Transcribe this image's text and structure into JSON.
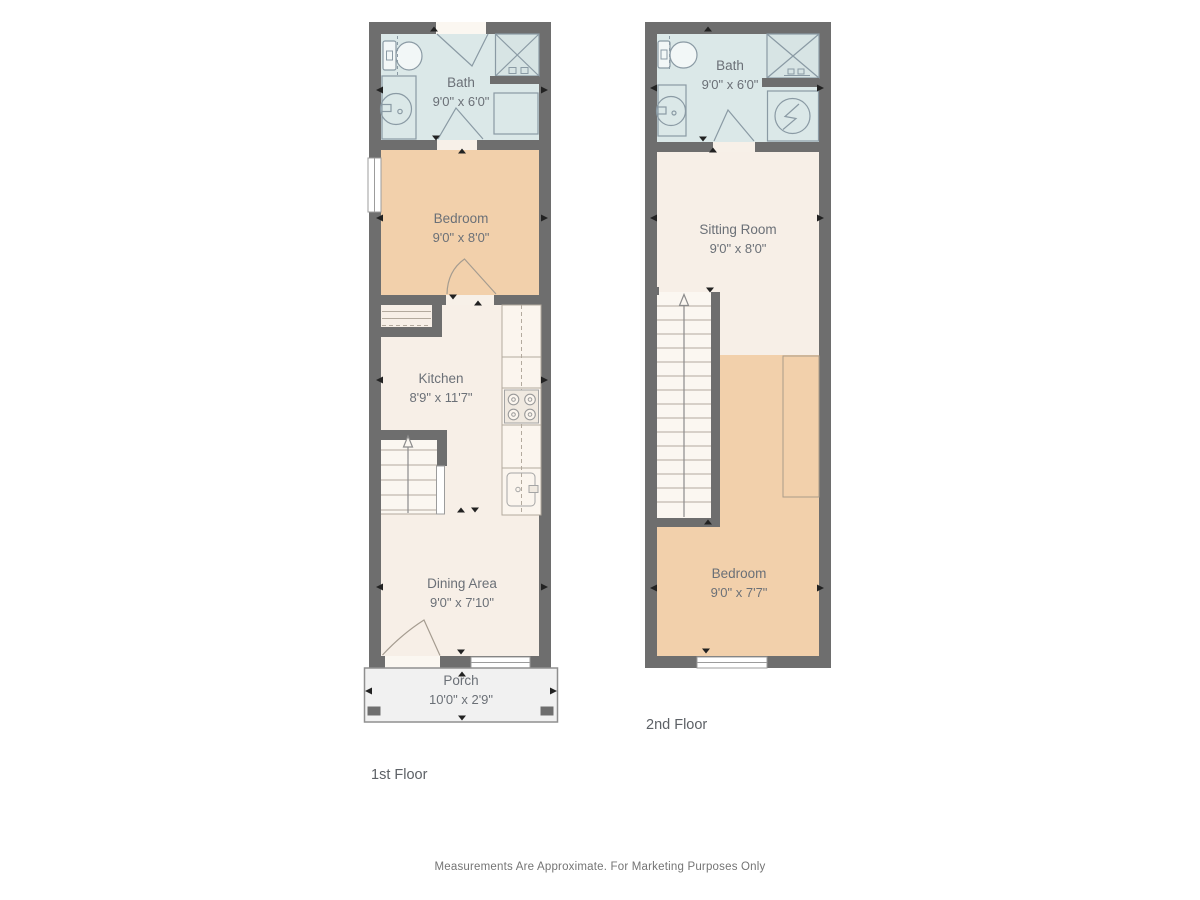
{
  "title": "Two-story townhouse floor plan",
  "colors": {
    "wall": "#6e6e6e",
    "bath": "#dbe8e8",
    "bedroom": "#f2d0ab",
    "cream": "#f7efe7",
    "porch": "#f1f1f1",
    "porch_border": "#8f8f8f",
    "stairs": "#fbf7f1",
    "opening": "#f7f0e8",
    "exterior_opening": "#fbf7f1",
    "window": "#ffffff",
    "window_border": "#9c9c9c",
    "fixture": "#8a9aa4",
    "wood": "#a59c90",
    "line": "#b3aa9e",
    "counter": "#fbf5ee",
    "stove": "#f0e9e0",
    "closet": "#ab9c8a",
    "arrow": "#222222",
    "label": "#6b7077",
    "floor_label": "#5d6166",
    "disclaimer": "#747474"
  },
  "floors": [
    {
      "label": "1st Floor",
      "rooms": [
        {
          "name": "Bath",
          "dims": "9'0\" x 6'0\"",
          "fixtures": [
            "toilet-icon",
            "vanity-sink-icon",
            "shower-icon",
            "linen-square-icon",
            "door-swing-icon"
          ]
        },
        {
          "name": "Bedroom",
          "dims": "9'0\" x 8'0\"",
          "fixtures": [
            "window-icon",
            "door-swing-icon"
          ]
        },
        {
          "name": "Kitchen",
          "dims": "8'9\" x 11'7\"",
          "fixtures": [
            "pantry-shelves-icon",
            "counter-icon",
            "stove-icon",
            "kitchen-sink-icon",
            "stairs-up-icon"
          ]
        },
        {
          "name": "Dining Area",
          "dims": "9'0\" x 7'10\"",
          "fixtures": [
            "door-swing-icon",
            "window-icon"
          ]
        },
        {
          "name": "Porch",
          "dims": "10'0\" x 2'9\"",
          "fixtures": [
            "porch-post-icon"
          ]
        }
      ]
    },
    {
      "label": "2nd Floor",
      "rooms": [
        {
          "name": "Bath",
          "dims": "9'0\" x 6'0\"",
          "fixtures": [
            "toilet-icon",
            "vanity-sink-icon",
            "shower-icon",
            "dryer-icon",
            "door-swing-icon"
          ]
        },
        {
          "name": "Sitting Room",
          "dims": "9'0\" x 8'0\"",
          "fixtures": [
            "stairs-up-icon"
          ]
        },
        {
          "name": "Bedroom",
          "dims": "9'0\" x 7'7\"",
          "fixtures": [
            "closet-outline-icon",
            "window-icon"
          ]
        }
      ]
    }
  ],
  "footer": {
    "disclaimer": "Measurements Are Approximate. For Marketing Purposes Only"
  }
}
